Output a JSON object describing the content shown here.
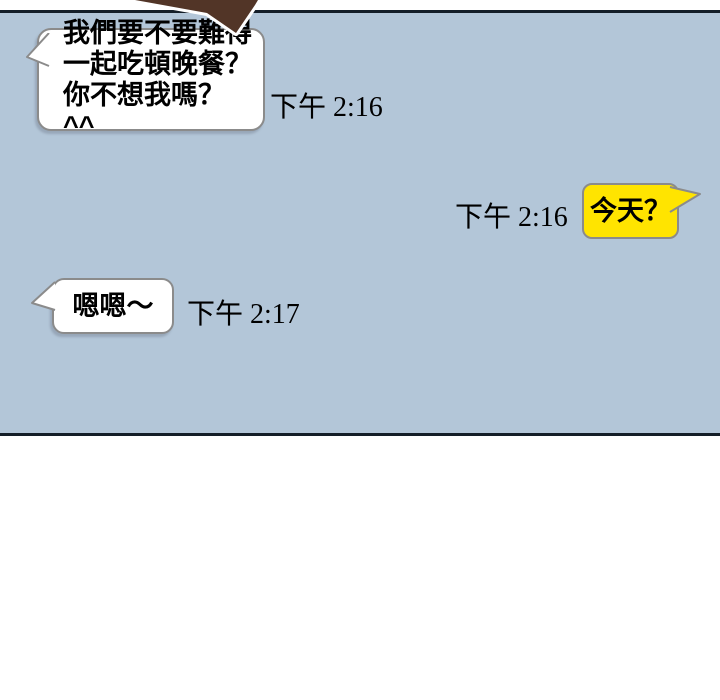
{
  "panel": {
    "background_color": "#b3c6d8",
    "border_color": "#141e28",
    "page_background": "#ffffff"
  },
  "decor": {
    "brown_speech_tail_color": "#523527",
    "brown_speech_tail_outline": "#ffffff"
  },
  "chat": {
    "bubble_colors": {
      "white": "#ffffff",
      "yellow": "#ffe400",
      "border": "#8b8b8b",
      "text": "#000000"
    },
    "messages": [
      {
        "side": "left",
        "bubble": "white",
        "text": "我們要不要難得\n一起吃頓晚餐？\n你不想我嗎？ ^^",
        "time": "下午 2:16"
      },
      {
        "side": "right",
        "bubble": "yellow",
        "text": "今天？",
        "time": "下午 2:16"
      },
      {
        "side": "left",
        "bubble": "white",
        "text": "嗯嗯～",
        "time": "下午 2:17"
      }
    ]
  }
}
